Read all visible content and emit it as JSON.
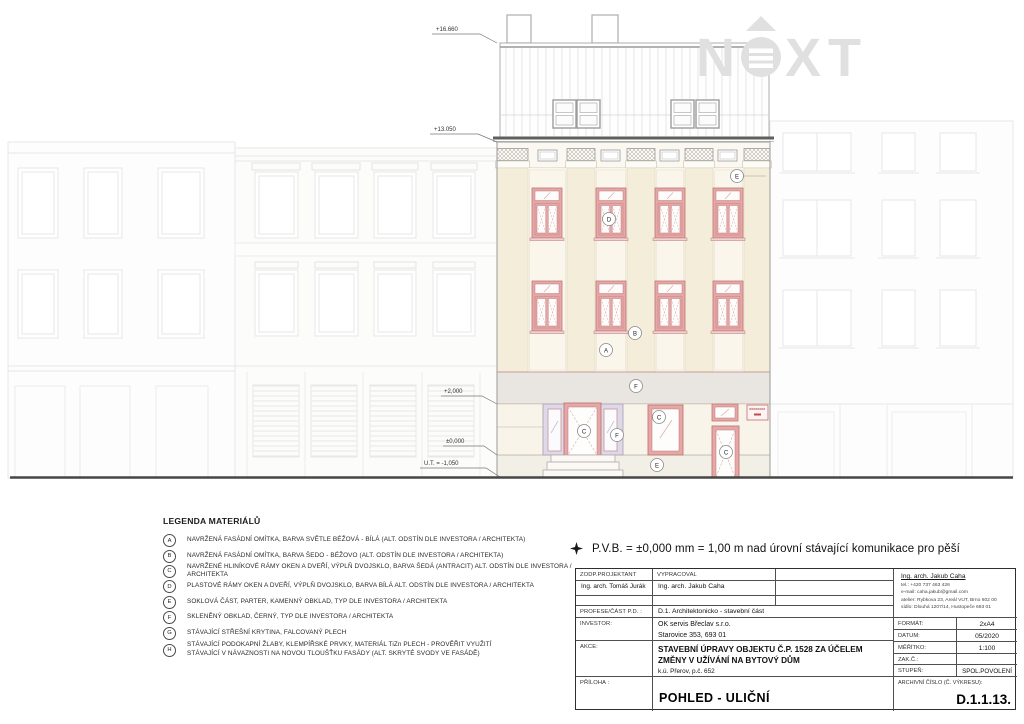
{
  "watermark": {
    "n": "N",
    "xt": "XT"
  },
  "elevations": {
    "roof_top": "+16.660",
    "eave": "+13.050",
    "parter": "+2,000",
    "zero": "±0,000",
    "terrain": "U.T. = -1,050"
  },
  "labels": {
    "a": "A",
    "b": "B",
    "c": "C",
    "d": "D",
    "e": "E",
    "f": "F"
  },
  "note": {
    "pvb": "P.V.B. = ±0,000 mm = 1,00 m nad úrovní stávající komunikace pro pěší"
  },
  "legend": {
    "title": "LEGENDA MATERIÁLŮ",
    "items": [
      {
        "key": "A",
        "text": "NAVRŽENÁ FASÁDNÍ OMÍTKA, BARVA SVĚTLE BÉŽOVÁ - BÍLÁ (ALT. ODSTÍN DLE INVESTORA / ARCHITEKTA)"
      },
      {
        "key": "B",
        "text": "NAVRŽENÁ FASÁDNÍ OMÍTKA, BARVA ŠEDO - BÉŽOVO (ALT. ODSTÍN DLE INVESTORA / ARCHITEKTA)"
      },
      {
        "key": "C",
        "text": "NAVRŽENÉ HLINÍKOVÉ RÁMY OKEN A DVEŘÍ, VÝPLŇ DVOJSKLO, BARVA ŠEDÁ (ANTRACIT) ALT. ODSTÍN DLE INVESTORA / ARCHITEKTA"
      },
      {
        "key": "D",
        "text": "PLASTOVÉ RÁMY OKEN A DVEŘÍ, VÝPLŇ DVOJSKLO, BARVA BÍLÁ ALT. ODSTÍN DLE INVESTORA / ARCHITEKTA"
      },
      {
        "key": "E",
        "text": "SOKLOVÁ ČÁST, PARTER, KAMENNÝ OBKLAD, TYP DLE INVESTORA / ARCHITEKTA"
      },
      {
        "key": "F",
        "text": "SKLENĚNÝ OBKLAD, ČERNÝ, TYP DLE INVESTORA / ARCHITEKTA"
      },
      {
        "key": "G",
        "text": "STÁVAJÍCÍ STŘEŠNÍ KRYTINA, FALCOVANÝ PLECH"
      },
      {
        "key": "H",
        "text": "STÁVAJÍCÍ PODOKAPNÍ ŽLABY, KLEMPÍŘSKÉ PRVKY, MATERIÁL TiZn PLECH - PROVĚŘIT VYUŽITÍ",
        "text2": "STÁVAJÍCÍ V NÁVAZNOSTI NA NOVOU TLOUŠŤKU FASÁDY (ALT. SKRYTÉ SVODY VE FASÁDĚ)"
      }
    ]
  },
  "titleblock": {
    "zodp_label": "ZODP.PROJEKTANT",
    "vypracoval_label": "VYPRACOVAL",
    "zodp_value": "Ing. arch. Tomáš Jurák",
    "vypracoval_value": "Ing. arch. Jakub Caha",
    "profese_label": "PROFESE/ČÁST P.D. :",
    "profese_value": "D.1. Architektonicko - stavební část",
    "investor_label": "INVESTOR:",
    "investor_line1": "OK servis Břeclav s.r.o.",
    "investor_line2": "Starovice 353, 693 01",
    "akce_label": "AKCE:",
    "akce_line1": "STAVEBNÍ ÚPRAVY OBJEKTU Č.P. 1528 ZA ÚČELEM",
    "akce_line2": "ZMĚNY V UŽÍVÁNÍ NA BYTOVÝ DŮM",
    "akce_line3": "k.ú. Přerov, p.č. 652",
    "priloha_label": "PŘÍLOHA :",
    "priloha_value": "POHLED - ULIČNÍ",
    "contact_name": "Ing. arch. Jakub Caha",
    "contact_tel": "tel.: +420 737 463 426",
    "contact_email": "e-mail: caha.jakub@gmail.com",
    "contact_atelier": "atelier: Rybkova 23, Areál VUT, Brno 602 00",
    "contact_sidlo": "sídlo: Dlouhá 1207/14, Hustopeče 693 01",
    "format_label": "FORMÁT:",
    "format_value": "2xA4",
    "datum_label": "DATUM:",
    "datum_value": "05/2020",
    "meritko_label": "MĚŘÍTKO:",
    "meritko_value": "1:100",
    "zakc_label": "ZAK.Č.:",
    "zakc_value": "",
    "stupen_label": "STUPEŇ:",
    "stupen_value": "SPOL.POVOLENÍ",
    "archiv_label": "ARCHIVNÍ ČÍSLO (Č. VÝKRESU):",
    "archiv_value": "D.1.1.13."
  }
}
